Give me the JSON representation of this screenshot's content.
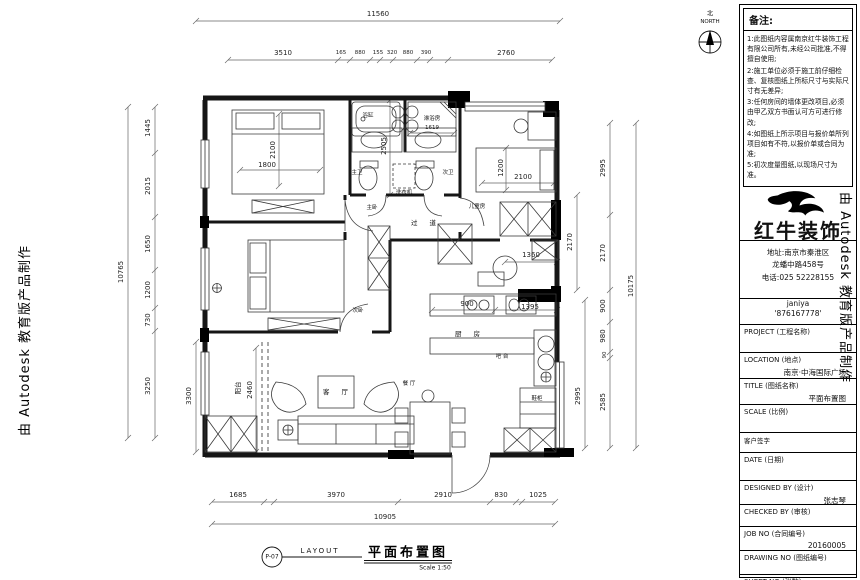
{
  "watermark": {
    "text": "由 Autodesk 教育版产品制作"
  },
  "north": {
    "cn": "北",
    "en": "NORTH"
  },
  "notes": {
    "title": "备注:",
    "items": [
      "1:此图纸内容属南京红牛装饰工程有限公司所有,未经公司批准,不得擅自使用;",
      "2:施工单位必须于施工前仔细检查、复核图纸上所标尺寸与实际尺寸有无差异;",
      "3:任何房间的墙体更改项目,必须由甲乙双方书面认可方可进行修改;",
      "4:如图纸上所示项目与报价单所列项目如有不符,以报价单或合同为准;",
      "5:初次度量图纸,以现场尺寸为准。"
    ]
  },
  "company": {
    "name": "红牛装饰",
    "address_line1": "地址:南京市秦淮区",
    "address_line2": "龙蟠中路458号",
    "phone": "电话:025 52228155",
    "contact": "janiya",
    "qq": "'876167778'"
  },
  "title_block": {
    "project_label": "PROJECT (工程名称)",
    "location_label": "LOCATION (地点)",
    "location_value": "南京·中海国际广场",
    "title_label": "TITLE (图纸名称)",
    "title_value": "平面布置图",
    "scale_label": "SCALE (比例)",
    "sign_label": "客户签字",
    "date_label": "DATE (日期)",
    "designed_label": "DESIGNED BY (设计)",
    "designed_value": "张志琴",
    "checked_label": "CHECKED BY (审核)",
    "job_label": "JOB  NO (合同编号)",
    "job_value": "20160005",
    "drawing_label": "DRAWING NO (图纸编号)",
    "sheet_label": "SHEET NO (张数)"
  },
  "footer": {
    "ref": "P-07",
    "layout_en": "LAYOUT",
    "title_cn": "平面布置图",
    "scale": "Scale 1:50"
  },
  "plan": {
    "dims": {
      "top_total": "11560",
      "top": [
        "3510",
        "165",
        "880",
        "155",
        "320",
        "880",
        "390",
        "2760"
      ],
      "left": [
        "1445",
        "2015",
        "1650",
        "1200",
        "730",
        "3250"
      ],
      "left_total": "10765",
      "left_inner": "3300",
      "balcony": "2460",
      "right": [
        "2995",
        "2170",
        "900",
        "980",
        "90",
        "2585"
      ],
      "right_total": "10175",
      "right_inner": [
        "2170",
        "2995"
      ],
      "bottom": [
        "1685",
        "3970",
        "2910",
        "830",
        "1025"
      ],
      "bottom_total": "10905",
      "master_bed": [
        "2100",
        "1800"
      ],
      "bath": [
        "2505",
        "1619"
      ],
      "kids_bed": [
        "1200",
        "2100"
      ],
      "kitchen": [
        "1360",
        "900",
        "1395"
      ]
    },
    "rooms": {
      "bathtub": "浴缸",
      "shower": "淋浴房",
      "master_bath": "主卫",
      "second_bath": "次卫",
      "washer": "洗衣机",
      "master_bedroom": "主卧",
      "kids_room": "儿童房",
      "corridor": "过 道",
      "second_bedroom": "次卧",
      "kitchen": "厨 房",
      "bar": "吧 台",
      "living": "客 厅",
      "dining": "餐 厅",
      "balcony": "阳台",
      "shoe_cabinet": "鞋柜"
    }
  }
}
